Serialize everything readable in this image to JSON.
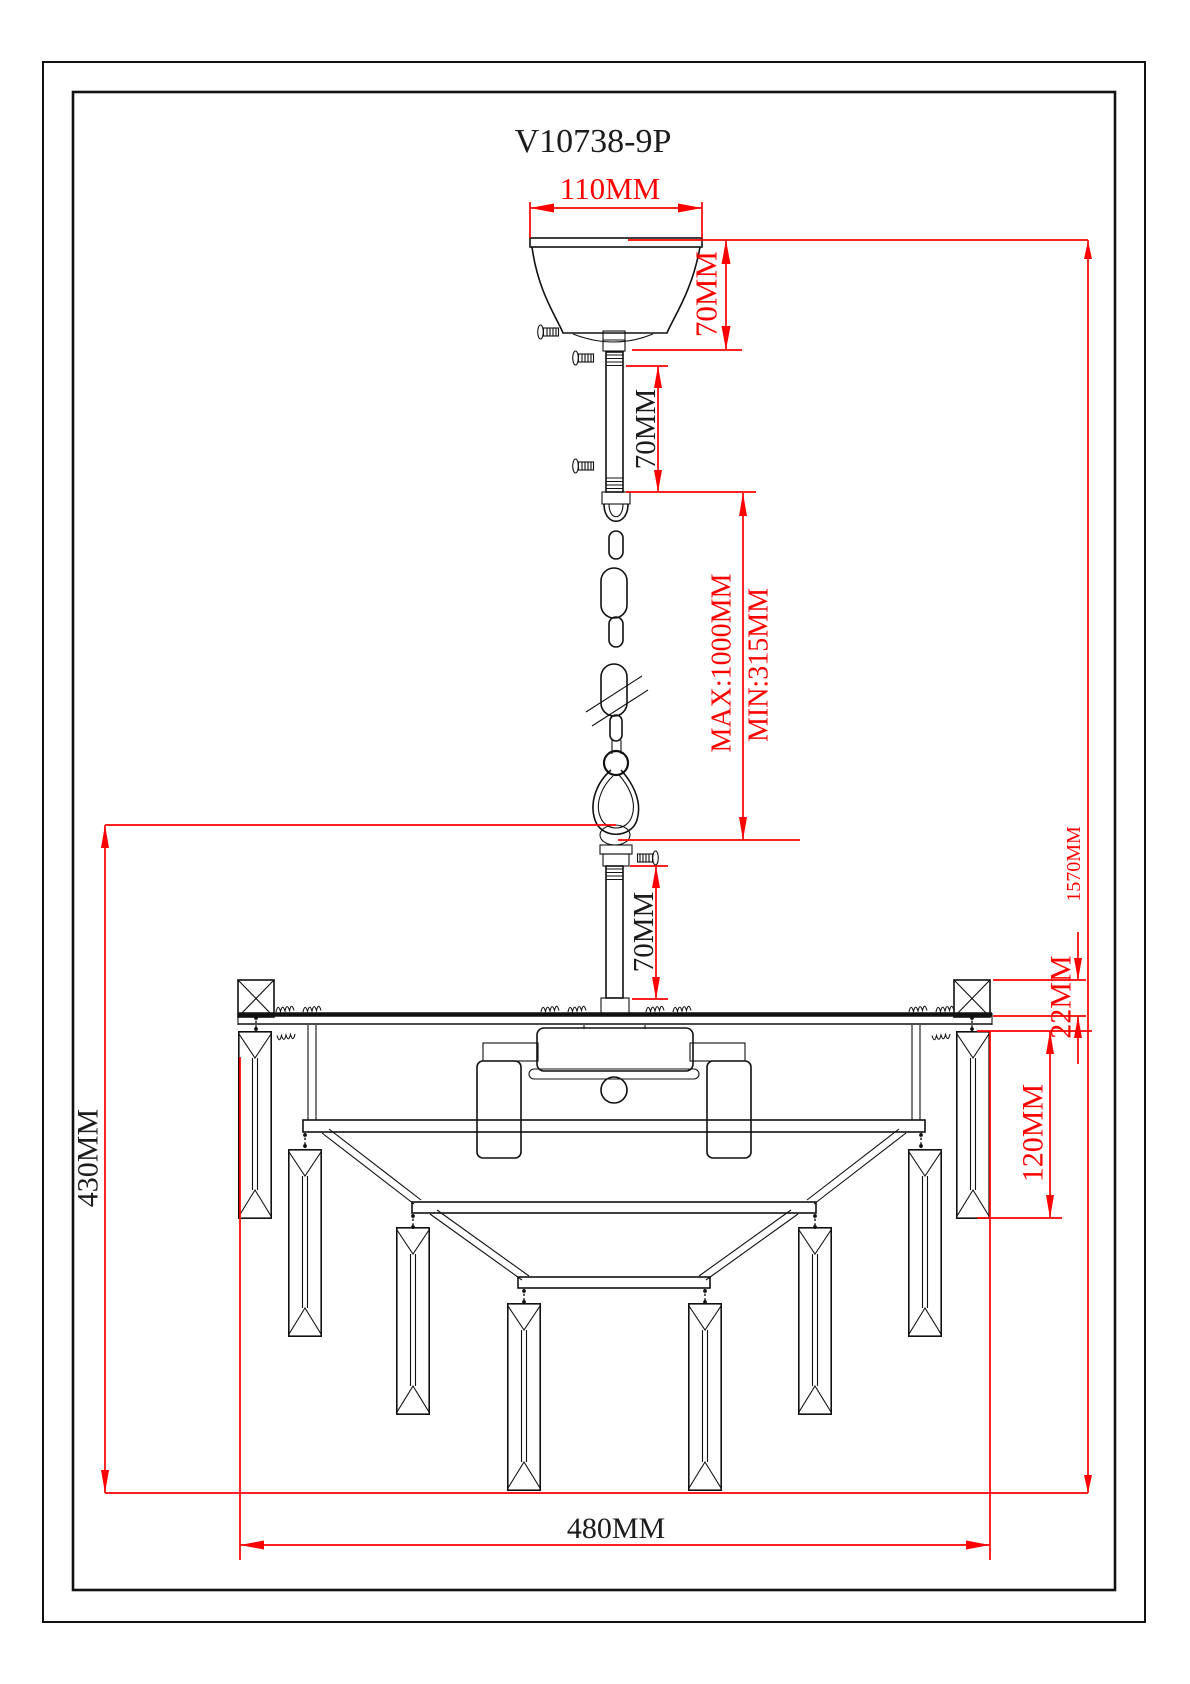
{
  "title": "V10738-9P",
  "labels": {
    "canopy_width": "110MM",
    "canopy_height": "70MM",
    "upper_pipe_height": "70MM",
    "chain_max": "MAX:1000MM",
    "chain_min": "MIN:315MM",
    "lower_pipe_height": "70MM",
    "total_drop": "1570MM",
    "top_bead_height": "22MM",
    "crystal_length": "120MM",
    "body_height": "430MM",
    "body_width": "480MM"
  },
  "colors": {
    "dimension_red": "#ff0000",
    "drawing_black": "#111111",
    "background": "#ffffff"
  }
}
